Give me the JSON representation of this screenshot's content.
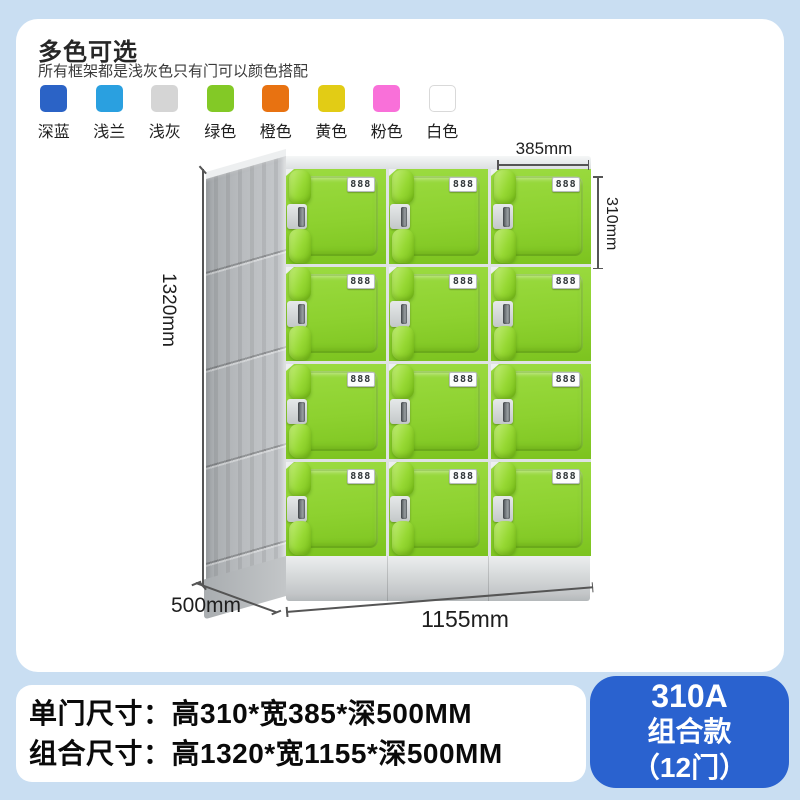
{
  "page": {
    "bg": "#c9def2",
    "card_bg": "#ffffff"
  },
  "header": {
    "title": "多色可选",
    "subtitle": "所有框架都是浅灰色只有门可以颜色搭配"
  },
  "color_options": [
    {
      "label": "深蓝",
      "hex": "#2b63c6"
    },
    {
      "label": "浅兰",
      "hex": "#2aa0e0"
    },
    {
      "label": "浅灰",
      "hex": "#d5d5d5"
    },
    {
      "label": "绿色",
      "hex": "#83c926"
    },
    {
      "label": "橙色",
      "hex": "#e87211"
    },
    {
      "label": "黄色",
      "hex": "#e2cc15"
    },
    {
      "label": "粉色",
      "hex": "#f970d9"
    },
    {
      "label": "白色",
      "hex": "#ffffff",
      "border": "#d9d9d9"
    }
  ],
  "locker": {
    "rows": 4,
    "cols": 3,
    "door_label": "888",
    "door_color": "#8dd12f",
    "frame_color": "#dfe2e4",
    "side_color": "#b9bcbf",
    "base_color": "#d8dbdc"
  },
  "dimensions": {
    "door_width": "385mm",
    "door_height": "310mm",
    "total_height": "1320mm",
    "depth": "500mm",
    "total_width": "1155mm"
  },
  "specs": {
    "door_size": "单门尺寸：高310*宽385*深500MM",
    "combo_size": "组合尺寸：高1320*宽1155*深500MM"
  },
  "badge": {
    "model": "310A",
    "series": "组合款",
    "doors": "（12门）",
    "bg": "#2a62cf"
  }
}
